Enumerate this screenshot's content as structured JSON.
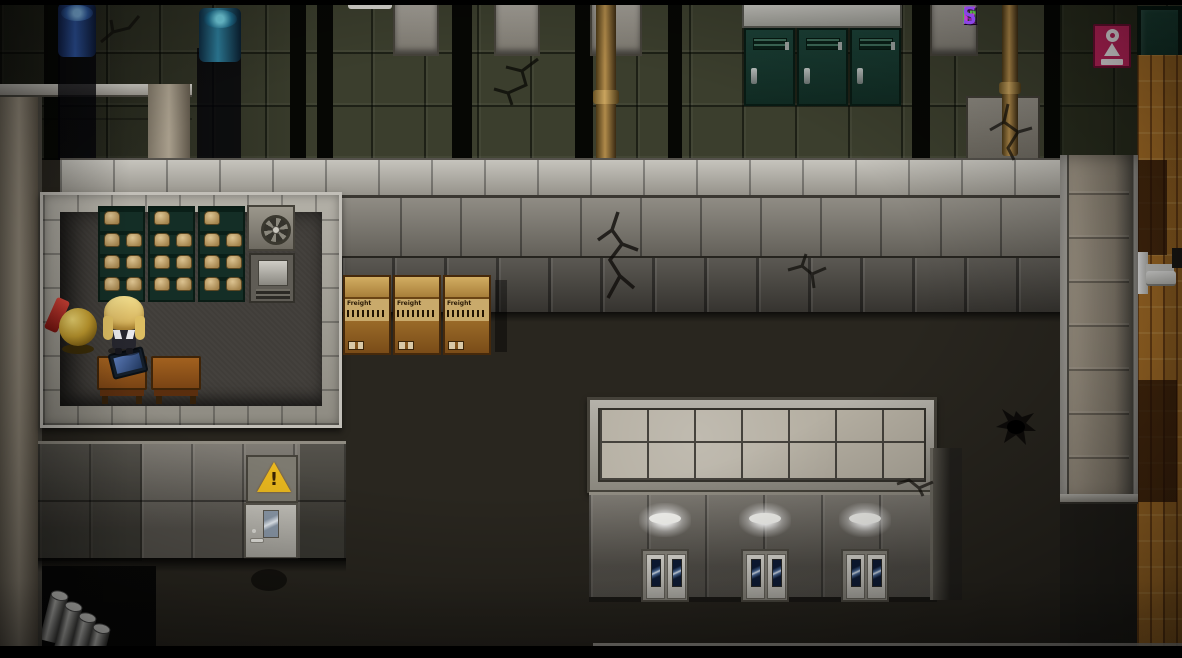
{
  "watermark": {
    "text": "PORNY GAMES",
    "letters": [
      {
        "ch": "P",
        "color": "#c238d8"
      },
      {
        "ch": "O",
        "color": "#52b43a"
      },
      {
        "ch": "R",
        "color": "#b238d8"
      },
      {
        "ch": "N",
        "color": "#52b43a"
      },
      {
        "ch": "Y",
        "color": "#9a42e0"
      },
      {
        "ch": " ",
        "color": ""
      },
      {
        "ch": "G",
        "color": "#52b43a"
      },
      {
        "ch": "A",
        "color": "#c238d8"
      },
      {
        "ch": "M",
        "color": "#52b43a"
      },
      {
        "ch": "E",
        "color": "#c238d8"
      },
      {
        "ch": "S",
        "color": "#8a46e6"
      }
    ]
  },
  "scene": {
    "crates": {
      "count": 3,
      "label": "Freight"
    },
    "warning_sign": {
      "symbol": "!"
    },
    "restroom_sign": {
      "figure": "woman-icon"
    },
    "skylight": {
      "cols": 7,
      "rows": 2
    },
    "lockers": {
      "count": 3
    },
    "south_doors": {
      "count": 3
    },
    "shelves": {
      "units": 3,
      "sack_pattern": [
        [
          0
        ],
        [
          0,
          1
        ],
        [
          0,
          1
        ],
        [
          0,
          1
        ]
      ]
    },
    "desks": {
      "count": 2
    },
    "drums": {
      "count": 4
    },
    "water_barrels": {
      "count": 2
    }
  },
  "colors": {
    "watermark_magenta": "#c238d8",
    "watermark_green": "#52b43a",
    "locker_green": "#16332b",
    "crate_brown": "#9d6b2a",
    "parquet_orange": "#b5782a",
    "sign_pink": "#c2255e",
    "warning_yellow": "#eab81e",
    "hallway_tile": "#3b3e2d",
    "warehouse_floor": "#29261f"
  }
}
